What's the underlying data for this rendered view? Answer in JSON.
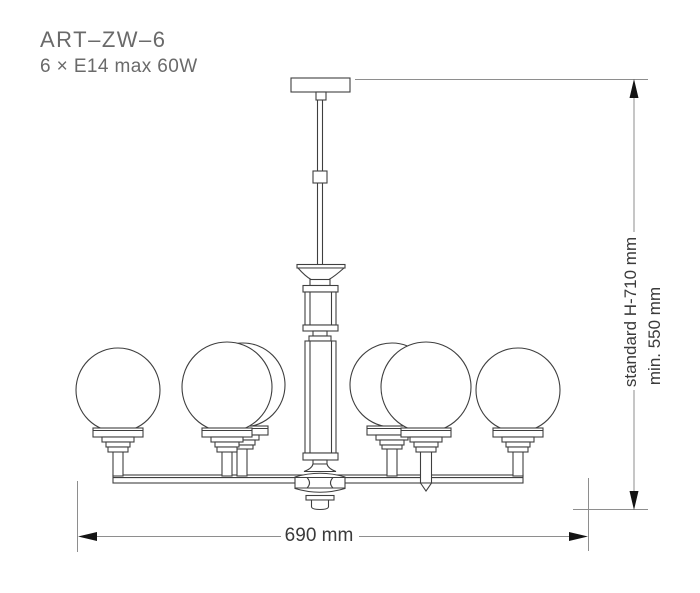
{
  "product": {
    "code": "ART–ZW–6",
    "spec": "6 × E14 max 60W"
  },
  "dimensions": {
    "width": "690 mm",
    "height_standard": "standard H-710 mm",
    "height_min": "min. 550 mm"
  },
  "drawing": {
    "subject": "front elevation line drawing of a 6-light chandelier with globe glass shades on a straight arm bar and cylindrical center column",
    "globe_count": 6,
    "colors": {
      "background": "#ffffff",
      "fixture_line": "#3f3f3f",
      "dimension_line": "#8e8e8e",
      "arrow": "#141414",
      "dimension_text": "#3a3a3a",
      "title_text": "#6a6a6a"
    }
  }
}
